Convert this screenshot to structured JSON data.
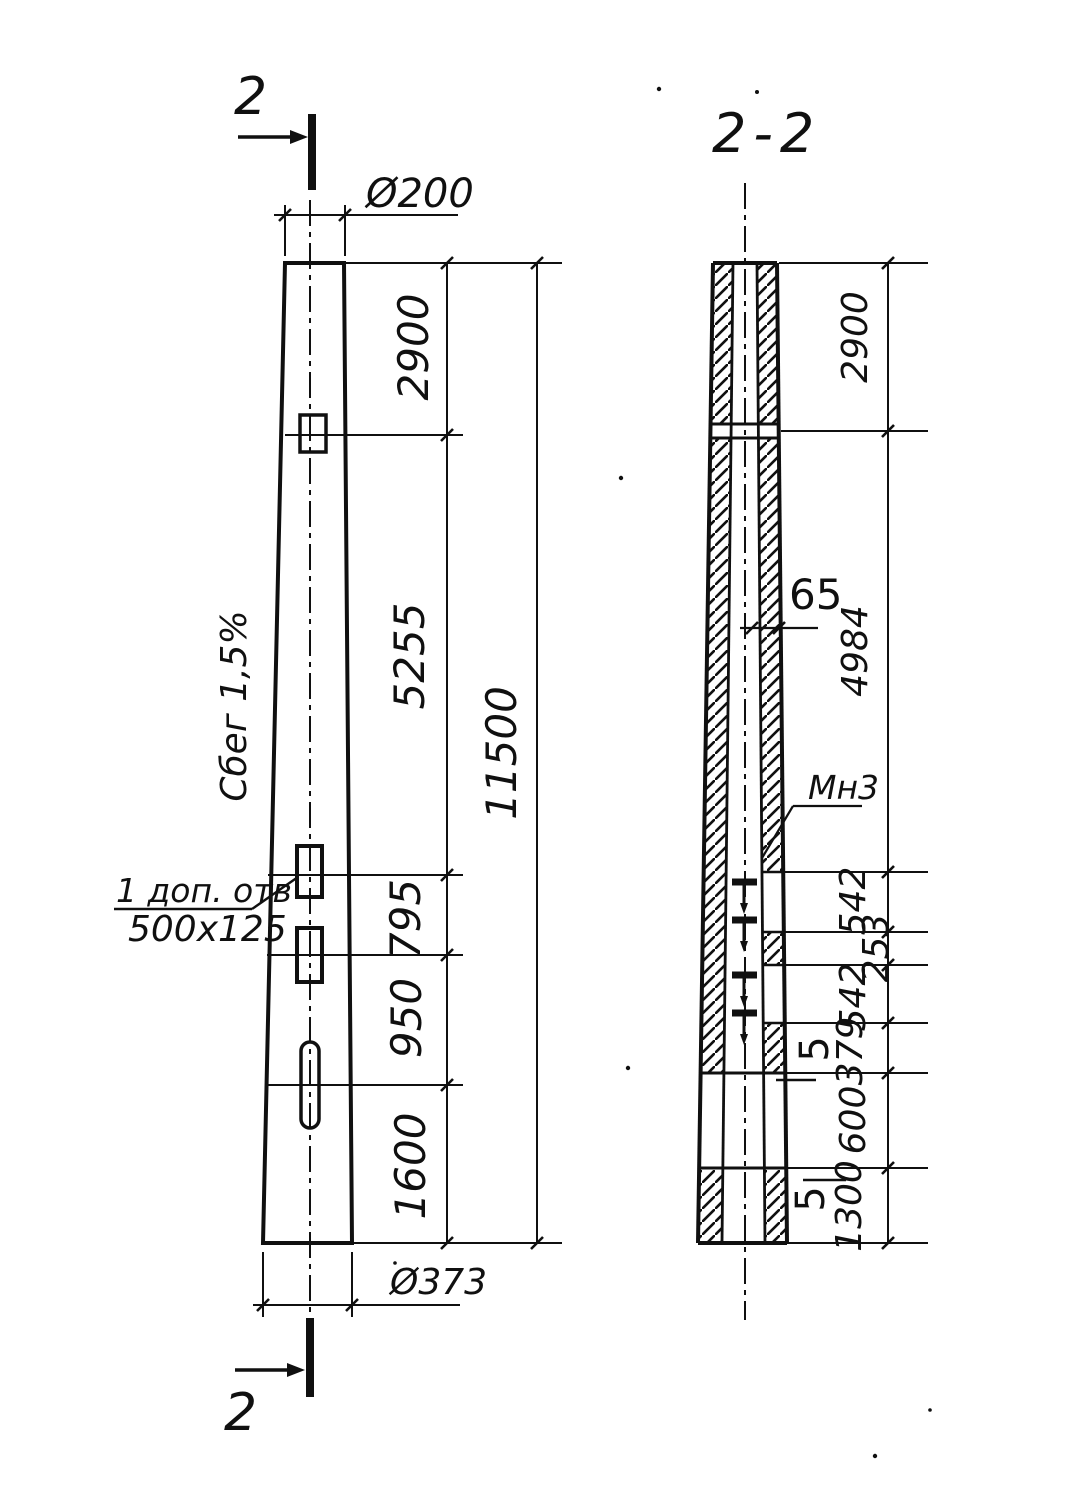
{
  "front_view": {
    "cut_top": "2",
    "cut_bottom": "2",
    "dia_top": "Ø200",
    "dia_bottom": "Ø373",
    "taper": "Сбег 1,5%",
    "note_line1": "1 доп. отв",
    "note_line2": "500x125",
    "dim_top": "2900",
    "dim_mid": "5255",
    "dim_a": "795",
    "dim_b": "950",
    "dim_c": "1600",
    "dim_total": "11500"
  },
  "section": {
    "title": "2-2",
    "wall_thickness": "65",
    "embed_label": "Мн3",
    "dim_top": "2900",
    "dim_mid": "4984",
    "dim_a": "542",
    "dim_b": "253",
    "dim_c": "542",
    "dim_d": "379",
    "dim_e": "600",
    "dim_f": "1300",
    "gap_a": "5",
    "gap_b": "5"
  }
}
